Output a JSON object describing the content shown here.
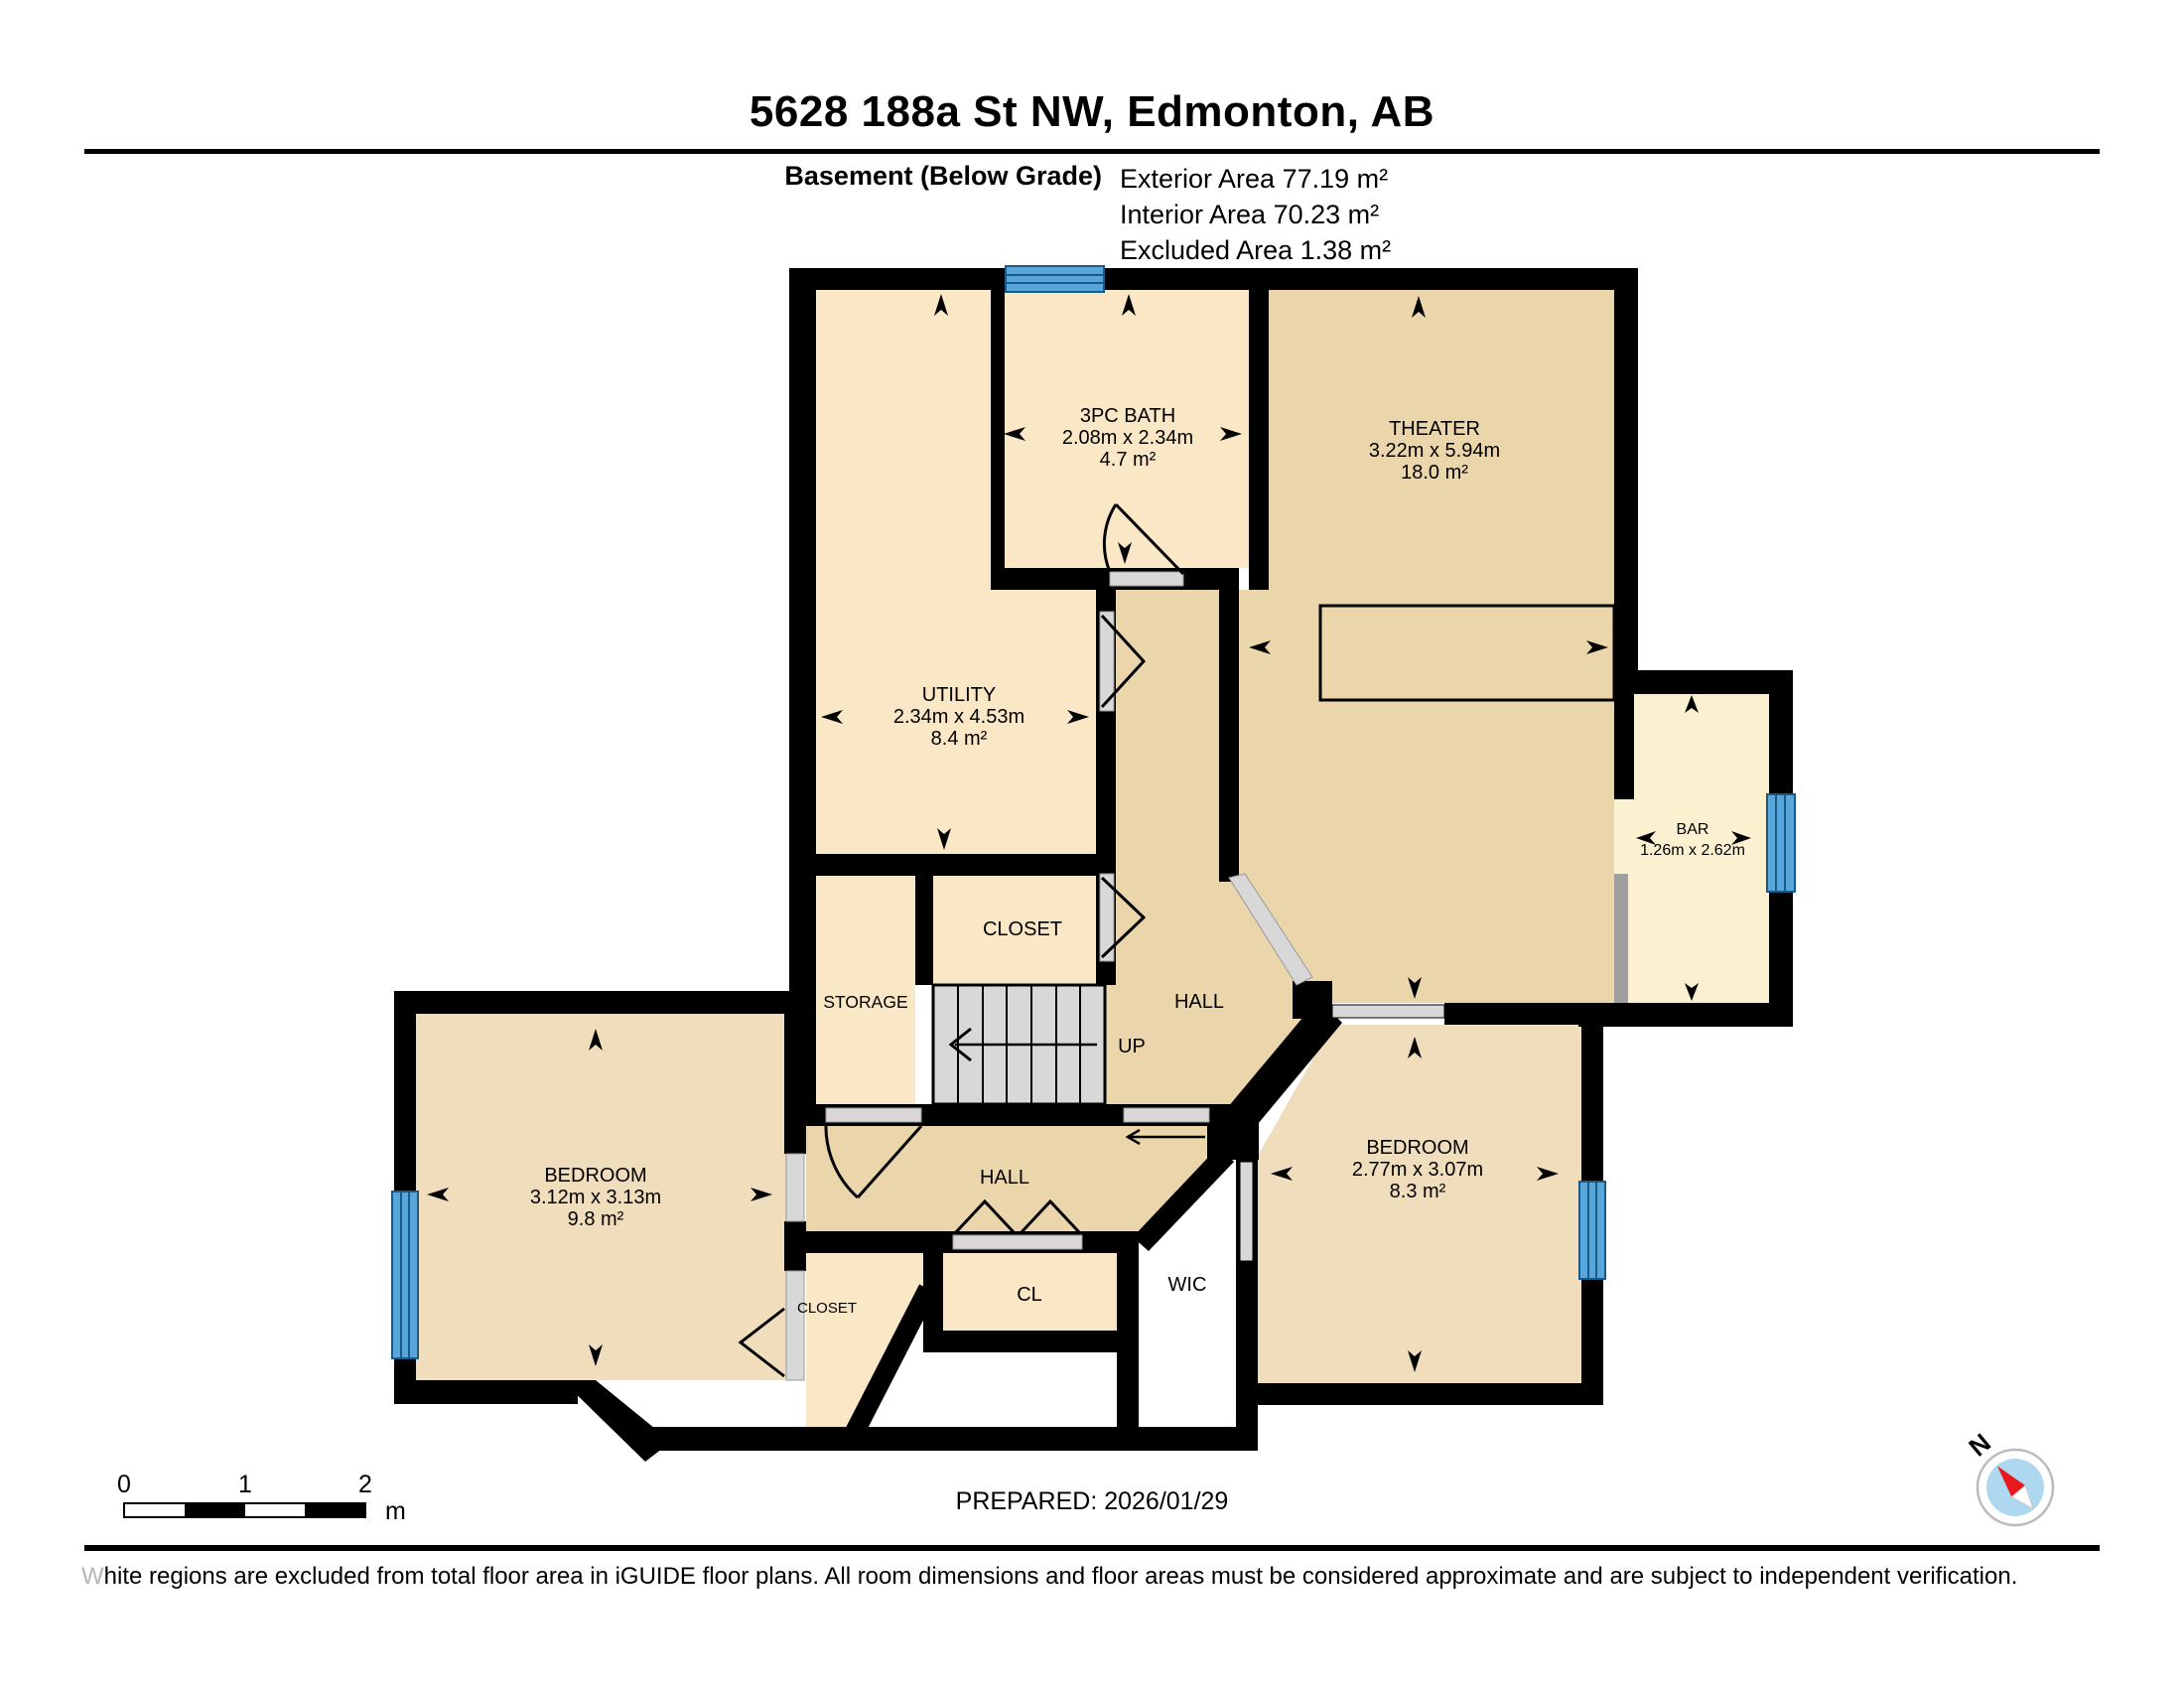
{
  "header": {
    "title": "5628 188a St NW, Edmonton, AB",
    "floor_label": "Basement (Below Grade)",
    "exterior_line": "Exterior Area 77.19 m²",
    "interior_line": "Interior Area 70.23 m²",
    "excluded_line": "Excluded Area 1.38 m²"
  },
  "rooms": {
    "bath": {
      "name": "3PC BATH",
      "dims": "2.08m x 2.34m",
      "area": "4.7 m²"
    },
    "theater": {
      "name": "THEATER",
      "dims": "3.22m x 5.94m",
      "area": "18.0 m²"
    },
    "utility": {
      "name": "UTILITY",
      "dims": "2.34m x 4.53m",
      "area": "8.4 m²"
    },
    "bar": {
      "name": "BAR",
      "dims": "1.26m x 2.62m"
    },
    "bedroom_left": {
      "name": "BEDROOM",
      "dims": "3.12m x 3.13m",
      "area": "9.8 m²"
    },
    "bedroom_right": {
      "name": "BEDROOM",
      "dims": "2.77m x 3.07m",
      "area": "8.3 m²"
    },
    "hall_upper": {
      "name": "HALL"
    },
    "hall_lower": {
      "name": "HALL"
    },
    "up": {
      "name": "UP"
    },
    "storage": {
      "name": "STORAGE"
    },
    "closet_upper": {
      "name": "CLOSET"
    },
    "closet_lower": {
      "name": "CLOSET"
    },
    "cl": {
      "name": "CL"
    },
    "wic": {
      "name": "WIC"
    }
  },
  "scale_bar": {
    "tick0": "0",
    "tick1": "1",
    "tick2": "2",
    "unit": "m"
  },
  "compass": {
    "north": "N"
  },
  "footer": {
    "prepared": "PREPARED: 2026/01/29",
    "disclaimer": "White regions are excluded from total floor area in iGUIDE floor plans. All room dimensions and floor areas must be considered approximate and are subject to independent verification."
  },
  "colors": {
    "wall": "#000000",
    "room_cream": "#FAE7C5",
    "room_tan": "#EBD6AC",
    "room_bedroom": "#F0DDBC",
    "bar_cream": "#FBF0CF",
    "door_gray": "#D8D8D8",
    "counter_gray": "#9E9E9E",
    "window_blue": "#57A7DC",
    "compass_blue": "#AED7F0",
    "needle_red": "#E8191C"
  }
}
